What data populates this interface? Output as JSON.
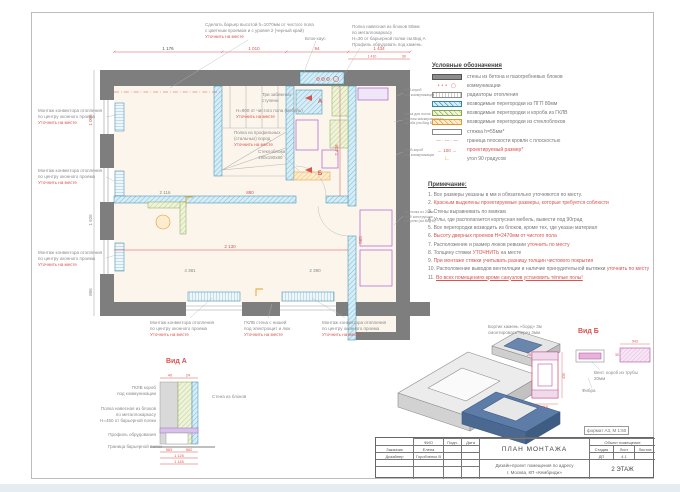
{
  "sheet": {
    "format_scale": "формат А3, М 1:50"
  },
  "colors": {
    "wall": "#7e7e7e",
    "red_accent": "#d9534f",
    "partition_blue": "#2f89ad",
    "gklv_green": "#8aa84f",
    "glassblock_orange": "#e09a30",
    "fixture_magenta": "#b4479f",
    "iso_navy": "#4a6890",
    "floor_cream": "#fbf5ec"
  },
  "legend": {
    "title": "Условные обозначения",
    "items": [
      {
        "type": "solid-gray",
        "symbol": "",
        "label": "стены из бетона и пазогребневых блоков"
      },
      {
        "type": "comm",
        "symbol": "∘∘∘ ◯",
        "label": "коммуникации"
      },
      {
        "type": "radiator",
        "symbol": "",
        "label": "радиаторы отопления"
      },
      {
        "type": "hatch-blue",
        "symbol": "",
        "label": "возводимые перегородки из ПГП 80мм"
      },
      {
        "type": "hatch-green",
        "symbol": "",
        "label": "возводимые перегородки и короба из ГКЛВ"
      },
      {
        "type": "hatch-orange",
        "symbol": "",
        "label": "возводимые перегородки из стеклоблоков"
      },
      {
        "type": "screed",
        "symbol": "",
        "label": "стяжка h=55мм*"
      },
      {
        "type": "dashdot",
        "symbol": "— · — · —",
        "label": "граница плоскости кровли с плоскостью"
      },
      {
        "type": "reddim",
        "symbol": "← 100 →",
        "label": "проектируемый размер*",
        "red": "1"
      },
      {
        "type": "angle",
        "symbol": "∟",
        "label": "угол 90 градусов"
      }
    ]
  },
  "notes": {
    "title": "Примечание:",
    "items": [
      {
        "n": "1",
        "pre": "Все размеры указаны в мм и обязательно уточняются по месту.",
        "red": "",
        "post": ""
      },
      {
        "n": "2",
        "pre": "",
        "red": "Красным выделены проектируемые размеры, которые требуется соблюсти",
        "post": ""
      },
      {
        "n": "3",
        "pre": "Стены выравнивать по маякам",
        "red": "",
        "post": ""
      },
      {
        "n": "4",
        "pre": "Углы, где располагается корпусная мебель, вывести под 90град",
        "red": "",
        "post": ""
      },
      {
        "n": "5",
        "pre": "Все перегородки возводить из блоков, кроме тех, где указан материал",
        "red": "",
        "post": ""
      },
      {
        "n": "6",
        "pre": "",
        "red": "Высоту дверных проемов Н=2470мм от чистого пола",
        "post": ""
      },
      {
        "n": "7",
        "pre": "Расположение и размер люков ревизии ",
        "red": "уточнить по месту",
        "post": ""
      },
      {
        "n": "8",
        "pre": "Толщину стяжки ",
        "red": "УТОЧНИТЬ",
        "post": " на месте"
      },
      {
        "n": "9",
        "pre": "",
        "red": "При монтаже стяжки учитывать разницу толщин чистового покрытия",
        "post": ""
      },
      {
        "n": "10",
        "pre": "Расположение выводов вентиляции и наличие принудительной вытяжки ",
        "red": "уточнить по месту",
        "post": ""
      },
      {
        "n": "11",
        "pre": "",
        "red": "Во всех помещениях кроме санузлов установить тёплые полы!",
        "post": ""
      }
    ]
  },
  "plan": {
    "annotations": {
      "conv": {
        "l1": "Монтаж конвектора отопления",
        "l2": "по центру оконного проема",
        "red": "Уточнить на месте"
      },
      "barrier": {
        "l1": "Сделать барьер высотой h=1070мм от чистого пола",
        "l2": "с цветным проемом и с уровня 2 (черный край)",
        "red": "Уточнить на месте"
      },
      "blockhaus": {
        "l1": "Блок-хаус"
      },
      "shelf_top": {
        "l1": "Полка навесная из блоков 50мм",
        "l2": "по металлокаркасу",
        "l3": "Н=30 от барьерной полки см.Вид А",
        "l4": "Профиль обрудовать под камень"
      },
      "duct1": {
        "l1": "ПГП-короб",
        "l2": "под коммуникации"
      },
      "niche": {
        "l1": "Ниша для полок",
        "l2": "Монтаж маскировочного",
        "l3": "короба (см.Вид Б)"
      },
      "duct2": {
        "l1": "ГКЛВ-короб",
        "l2": "под коммуникации"
      },
      "damper": {
        "l1": "Заслонка из 20мм",
        "l2": "МДФ конструкция",
        "l3": "из кухни (см.Вид Б)"
      },
      "wall_niche": {
        "l1": "ГКЛВ стена с нишей",
        "l2": "под электрощит и люк",
        "red": "Уточнить на месте"
      },
      "glass": {
        "l1": "Стеклоблоки",
        "l2": "190х190х80"
      },
      "shelf_profile": {
        "l1": "Полка из профильных",
        "l2": "(стальных) пород",
        "red": "Уточнить на месте"
      },
      "furniture_h": {
        "l1": "Н=900 от чистого пола (мебель)",
        "red": "Уточнить на месте"
      },
      "winders": {
        "l1": "Три забежных",
        "l2": "ступени"
      }
    },
    "dims": {
      "t1": "1 176",
      "t2": "1 010",
      "t3": "94",
      "t4": "1 434",
      "t5": "1 410",
      "t6": "30",
      "left1": "1 006",
      "left2": "1 926",
      "left3": "806",
      "b1": "4 381",
      "b2": "2 380",
      "i1": "2 436",
      "i2": "2 130",
      "i3": "565",
      "i4": "880",
      "i5": "2 116"
    },
    "markers": {
      "a": "А",
      "b": "Б"
    }
  },
  "views": {
    "a": {
      "label": "Вид А",
      "l1a": "ГКЛВ короб",
      "l1b": "под коммуникации",
      "l2a": "Полка навесная из блоков",
      "l2b": "по металлокаркасу",
      "l2c": "Н=450 от барьерной полки",
      "l3": "Профиль обрудования",
      "l4": "Граница барьерной полки",
      "r1": "Стена из блоков",
      "dims": {
        "d1": "563",
        "d2": "562",
        "d3": "1 125",
        "d4": "1 145",
        "d5": "40",
        "d6": "24"
      }
    },
    "b": {
      "label": "Вид Б",
      "note1a": "Бортик камень «борд» 3м",
      "note1b": "смонтировать через 3мм",
      "note2a": "Вент. короб из трубы",
      "note2b": "20мм",
      "note3": "Фибра",
      "dims": {
        "d1": "25",
        "d2": "430",
        "d3": "118",
        "d4": "543",
        "d5": "30"
      }
    }
  },
  "titleblock": {
    "format": "формат А3, М 1:50",
    "col_fio": "ФИО",
    "col_sign": "Подп.",
    "col_date": "Дата",
    "row1_role": "Заказчик",
    "row1_name": "Елена",
    "row2_role": "Дизайнер",
    "row2_name": "Горобченко В",
    "doc_title": "ПЛАН МОНТАЖА",
    "project1": "Дизайн-проект помещения по адресу",
    "project2": "г. Москва, КП «Кембридж»",
    "object": "Объект помещение",
    "stage_l": "Стадия",
    "sheet_l": "Лист",
    "sheets_l": "Листов",
    "stage": "ДП",
    "sheet": "4.1",
    "floor": "2 ЭТАЖ"
  }
}
